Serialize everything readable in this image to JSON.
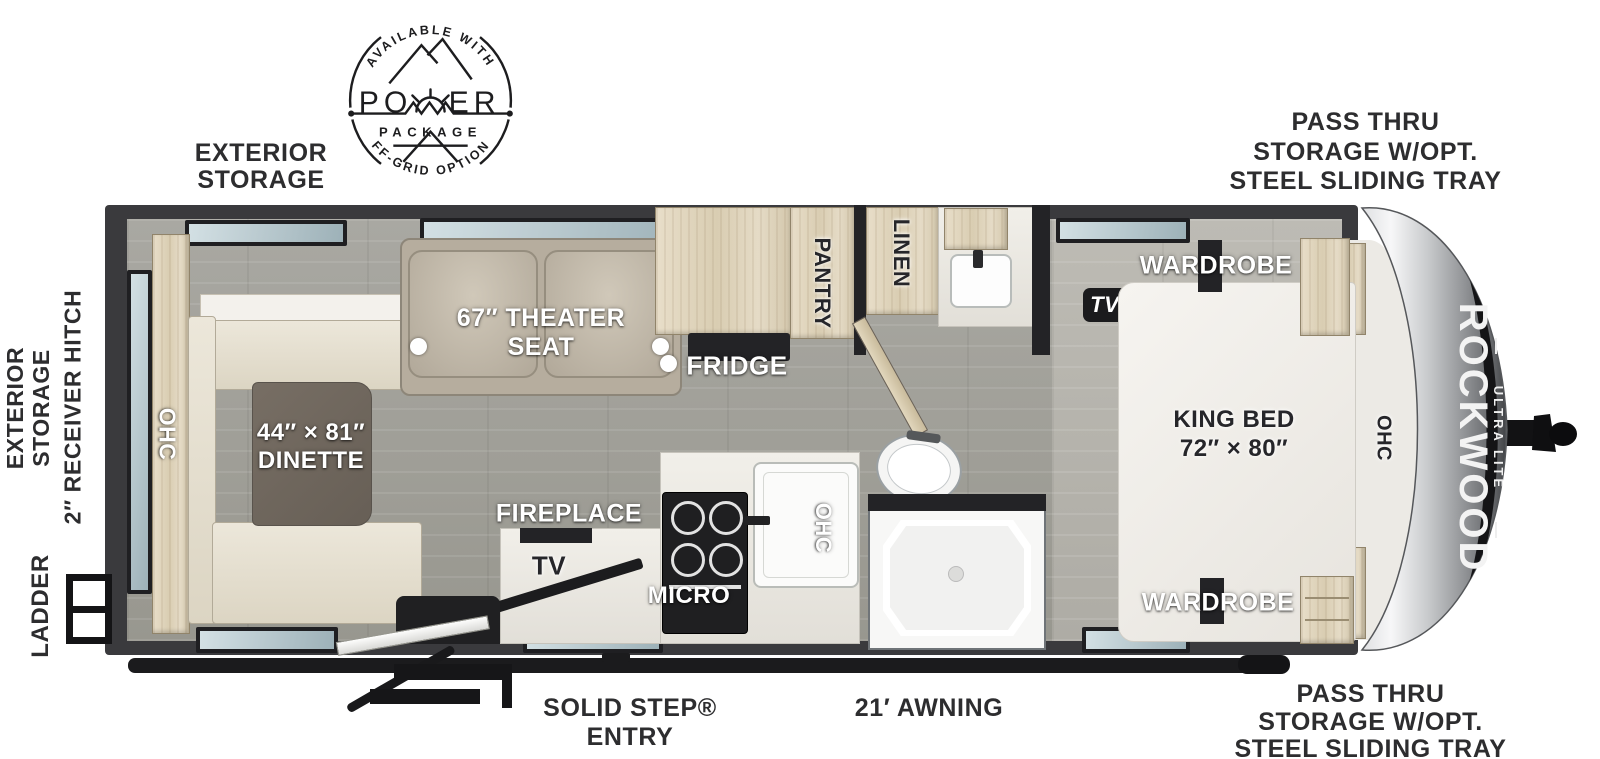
{
  "badge": {
    "arc_top": "AVAILABLE WITH",
    "power_left": "PO",
    "power_right": "ER",
    "package": "PACKAGE",
    "arc_bottom": "OFF-GRID OPTIONS"
  },
  "exterior": {
    "top_left": [
      "EXTERIOR",
      "STORAGE"
    ],
    "top_right": [
      "PASS THRU",
      "STORAGE W/OPT.",
      "STEEL SLIDING TRAY"
    ],
    "bottom_right": [
      "PASS THRU",
      "STORAGE W/OPT.",
      "STEEL SLIDING TRAY"
    ],
    "side_storage": [
      "EXTERIOR",
      "STORAGE"
    ],
    "receiver_hitch": "2″ RECEIVER HITCH",
    "ladder": "LADDER",
    "solid_step": "SOLID STEP® ENTRY",
    "awning": "21′ AWNING"
  },
  "interior": {
    "rear_ohc": "OHC",
    "dinette_line1": "44″ × 81″",
    "dinette_line2": "DINETTE",
    "theater_line1": "67″ THEATER",
    "theater_line2": "SEAT",
    "fridge": "FRIDGE",
    "pantry": "PANTRY",
    "linen": "LINEN",
    "fireplace": "FIREPLACE",
    "tv": "TV",
    "micro": "MICRO",
    "kitchen_ohc": "OHC",
    "tv_opt": "TV Opt.",
    "wardrobe_top": "WARDROBE",
    "wardrobe_bottom": "WARDROBE",
    "king_line1": "KING BED",
    "king_line2": "72″ × 80″",
    "front_ohc": "OHC"
  },
  "brand": {
    "name": "ROCKWOOD",
    "sub": "ULTRA LITE"
  }
}
